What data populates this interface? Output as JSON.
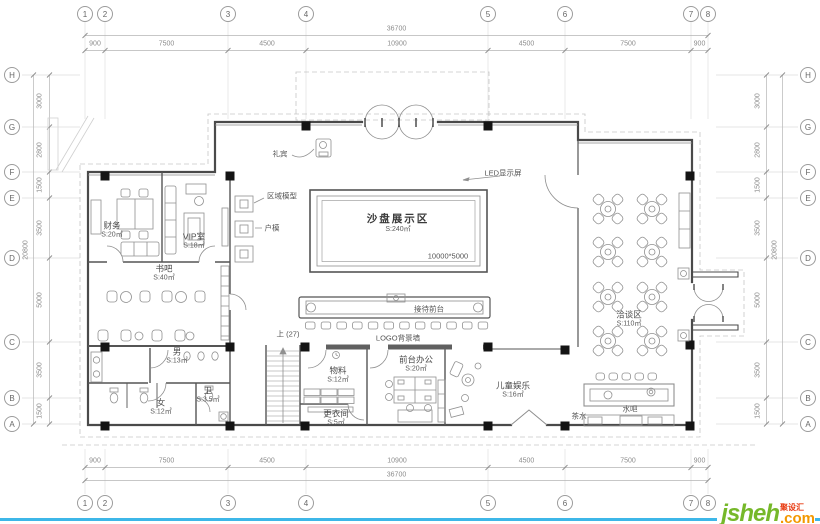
{
  "page": {
    "background": "#ffffff",
    "footer_line_color": "#3db7e8"
  },
  "logo": {
    "text": "jsheh",
    "tld": ".com",
    "tagline": "聚设汇",
    "color_text": "#76b82a",
    "color_tld": "#f39800",
    "color_tagline": "#e8380d"
  },
  "grid": {
    "bubble_columns": [
      {
        "id": "1",
        "x": 85
      },
      {
        "id": "2",
        "x": 105
      },
      {
        "id": "3",
        "x": 228
      },
      {
        "id": "4",
        "x": 306
      },
      {
        "id": "5",
        "x": 488
      },
      {
        "id": "6",
        "x": 565
      },
      {
        "id": "7",
        "x": 691
      },
      {
        "id": "8",
        "x": 708
      }
    ],
    "bubble_rows": [
      {
        "id": "H",
        "y": 75
      },
      {
        "id": "G",
        "y": 127
      },
      {
        "id": "F",
        "y": 172
      },
      {
        "id": "E",
        "y": 198
      },
      {
        "id": "D",
        "y": 258
      },
      {
        "id": "C",
        "y": 342
      },
      {
        "id": "B",
        "y": 398
      },
      {
        "id": "A",
        "y": 424
      }
    ],
    "h_dims": [
      "900",
      "7500",
      "4500",
      "10900",
      "4500",
      "7500",
      "900"
    ],
    "h_total": "36700",
    "v_dims": [
      "3000",
      "2800",
      "1500",
      "3500",
      "5000",
      "3500",
      "1500"
    ],
    "v_total": "20800"
  },
  "rooms": [
    {
      "name": "沙盘展示区",
      "area": "S:240㎡",
      "x": 398,
      "y": 224,
      "big": true
    },
    {
      "name": "洽谈区",
      "area": "S:110㎡",
      "x": 629,
      "y": 319
    },
    {
      "name": "书吧",
      "area": "S:40㎡",
      "x": 164,
      "y": 273
    },
    {
      "name": "财务",
      "area": "S:20㎡",
      "x": 112,
      "y": 230
    },
    {
      "name": "VIP室",
      "area": "S:18㎡",
      "x": 194,
      "y": 241
    },
    {
      "name": "男",
      "area": "S:13㎡",
      "x": 177,
      "y": 356
    },
    {
      "name": "女",
      "area": "S:12㎡",
      "x": 161,
      "y": 407
    },
    {
      "name": "卫",
      "area": "S:3.5㎡",
      "x": 208,
      "y": 395
    },
    {
      "name": "物料",
      "area": "S:12㎡",
      "x": 338,
      "y": 375
    },
    {
      "name": "更衣间",
      "area": "S:5㎡",
      "x": 336,
      "y": 418
    },
    {
      "name": "前台办公",
      "area": "S:20㎡",
      "x": 416,
      "y": 364
    },
    {
      "name": "儿童娱乐",
      "area": "S:16㎡",
      "x": 513,
      "y": 390
    }
  ],
  "annotations": [
    {
      "text": "礼宾",
      "x": 280,
      "y": 154
    },
    {
      "text": "区域模型",
      "x": 282,
      "y": 196
    },
    {
      "text": "户模",
      "x": 272,
      "y": 228
    },
    {
      "text": "LED显示屏",
      "x": 503,
      "y": 173
    },
    {
      "text": "接待前台",
      "x": 429,
      "y": 309
    },
    {
      "text": "LOGO背景墙",
      "x": 398,
      "y": 338
    },
    {
      "text": "上 (27)",
      "x": 288,
      "y": 334
    },
    {
      "text": "茶水",
      "x": 579,
      "y": 416
    },
    {
      "text": "水吧",
      "x": 630,
      "y": 409
    },
    {
      "text": "10000*5000",
      "x": 448,
      "y": 256
    }
  ]
}
